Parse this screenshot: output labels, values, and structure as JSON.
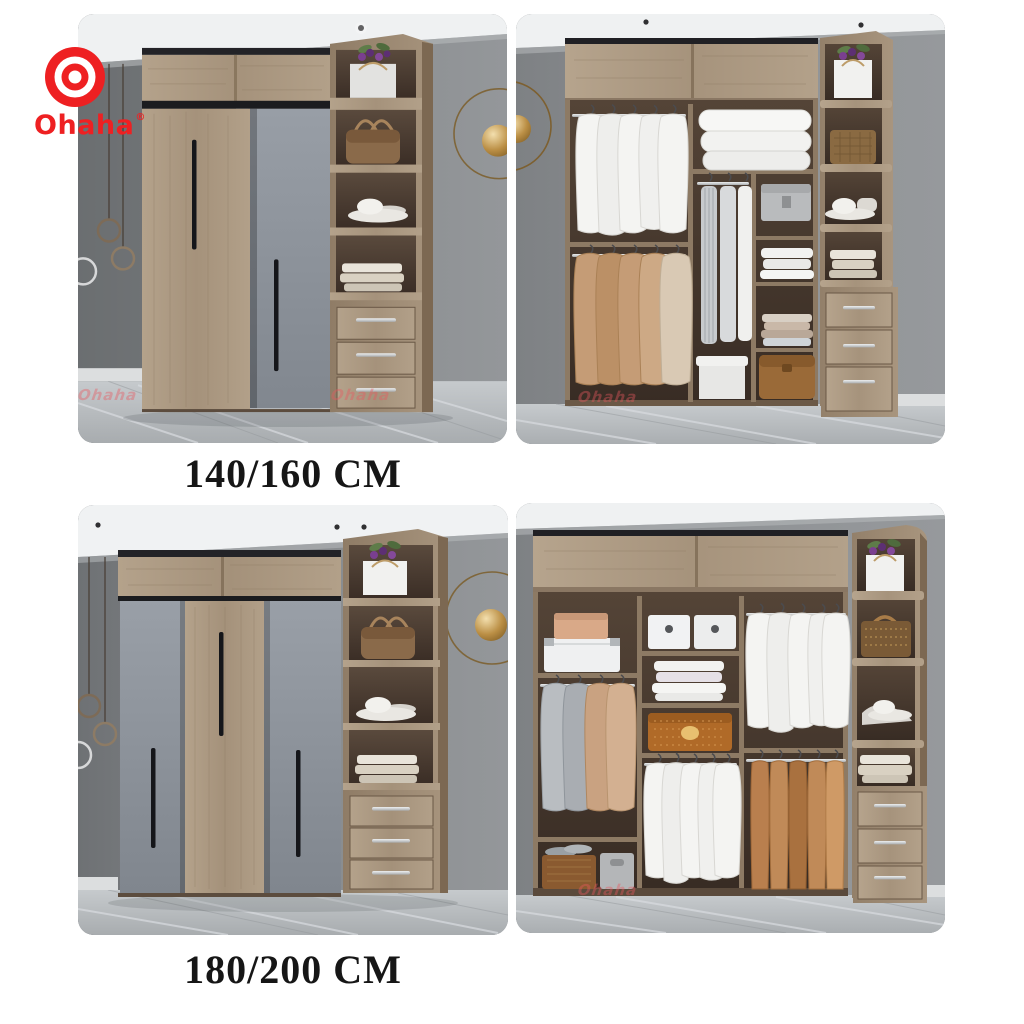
{
  "brand": {
    "name": "Ohaha",
    "registered_mark": "®",
    "color": "#ee2022"
  },
  "sections": [
    {
      "size_label": "140/160 CM",
      "photos": [
        {
          "alt": "Closed wardrobe, two sliding doors (wood and grey), side open shelf tower with gift bag, handbag, hats, folded clothes and three drawers, grey bedroom wall, marble floor"
        },
        {
          "alt": "Open wardrobe interior with hanging white shirts and tan coats, stacked pillows, hanging trousers, folded towels, storage boxes and side shelf tower with three drawers"
        }
      ]
    },
    {
      "size_label": "180/200 CM",
      "photos": [
        {
          "alt": "Closed wardrobe, three sliding doors (grey, wood, grey), side open shelf tower with gift bag, handbag, hats, folded clothes and three drawers, gold wall ring decor"
        },
        {
          "alt": "Open wardrobe interior with storage boxes, folded towels, patterned chest, hanging shirts, coats and trousers, side shelf tower with basket, hat and three drawers"
        }
      ]
    }
  ],
  "watermark": {
    "text": "Ohaha"
  },
  "palette": {
    "brand_red": "#ee2022",
    "label_ink": "#161616",
    "page_bg": "#ffffff",
    "wall_grey": "#8b8e91",
    "wood": "#b09d86",
    "wood_dark": "#6e5a48",
    "door_grey": "#8d939b",
    "interior_brown": "#46382f",
    "floor_marble": "#b6babd",
    "metal_silver": "#d4d7d9",
    "gold": "#a97f3c"
  }
}
